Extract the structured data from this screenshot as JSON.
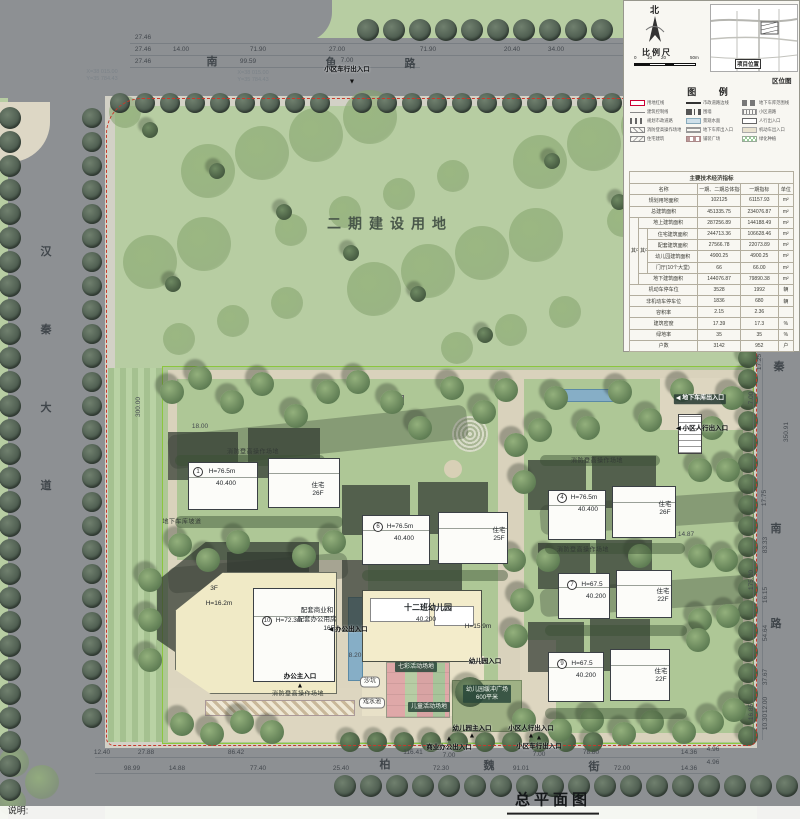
{
  "drawing_title": "总平面图",
  "notes_label": "说明:",
  "compass": {
    "north": "北"
  },
  "scale": {
    "label": "比例尺",
    "ticks": [
      "0",
      "10",
      "20",
      "50m"
    ]
  },
  "location_map": {
    "marker": "项目位置",
    "caption": "区位图"
  },
  "legend": {
    "title": "图  例",
    "items": [
      "用地红线",
      "市政道路边线",
      "地下车库范围线",
      "建筑控制线",
      "围墙",
      "小区道路",
      "规划市政道路",
      "景观水面",
      "人行出入口",
      "消防登高操作场地",
      "地下车库出入口",
      "机动车出入口",
      "住宅建筑",
      "铺装广场",
      "绿化种植"
    ]
  },
  "table": {
    "title": "主要技术经济指标",
    "qizhong": "其中",
    "header": [
      "名称",
      "一期、二期总体指标",
      "一期指标",
      "单位"
    ],
    "rows": [
      [
        "规划用地面积",
        "102125",
        "61157.93",
        "m²"
      ],
      [
        "总建筑面积",
        "451335.75",
        "234076.87",
        "m²"
      ],
      [
        "地上建筑面积",
        "287256.89",
        "144188.49",
        "m²"
      ],
      [
        "住宅建筑面积",
        "244713.36",
        "106628.46",
        "m²"
      ],
      [
        "配套建筑面积",
        "27566.78",
        "22073.89",
        "m²"
      ],
      [
        "幼儿园建筑面积",
        "4900.25",
        "4900.25",
        "m²"
      ],
      [
        "门厅(10个大堂)",
        "66",
        "66.00",
        "m²"
      ],
      [
        "地下建筑面积",
        "144076.87",
        "79890.38",
        "m²"
      ],
      [
        "机动车停车位",
        "3528",
        "1992",
        "辆"
      ],
      [
        "非机动车停车位",
        "1836",
        "680",
        "辆"
      ],
      [
        "容积率",
        "2.15",
        "2.36",
        ""
      ],
      [
        "建筑密度",
        "17.39",
        "17.3",
        "%"
      ],
      [
        "绿地率",
        "35",
        "35",
        "%"
      ],
      [
        "户数",
        "3142",
        "952",
        "户"
      ]
    ]
  },
  "annotations": {
    "headline": [
      {
        "t": "二期建设用地",
        "x": 390,
        "y": 224,
        "c": "big"
      },
      {
        "t": "总平面图",
        "x": 553,
        "y": 803,
        "c": "title"
      },
      {
        "t": "说明:",
        "x": 18,
        "y": 811,
        "c": "note"
      }
    ],
    "roads": [
      {
        "t": "汉",
        "x": 46,
        "y": 253
      },
      {
        "t": "秦",
        "x": 46,
        "y": 331
      },
      {
        "t": "大",
        "x": 46,
        "y": 409
      },
      {
        "t": "道",
        "x": 46,
        "y": 487
      },
      {
        "t": "南",
        "x": 212,
        "y": 63
      },
      {
        "t": "鱼",
        "x": 331,
        "y": 64
      },
      {
        "t": "路",
        "x": 410,
        "y": 65
      },
      {
        "t": "秦",
        "x": 779,
        "y": 368
      },
      {
        "t": "南",
        "x": 776,
        "y": 530
      },
      {
        "t": "路",
        "x": 776,
        "y": 625
      },
      {
        "t": "柏",
        "x": 385,
        "y": 766
      },
      {
        "t": "魏",
        "x": 489,
        "y": 767
      },
      {
        "t": "街",
        "x": 594,
        "y": 768
      }
    ],
    "dims_top": [
      {
        "t": "27.46",
        "x": 143,
        "y": 38
      },
      {
        "t": "27.46",
        "x": 143,
        "y": 50
      },
      {
        "t": "14.00",
        "x": 181,
        "y": 50
      },
      {
        "t": "71.90",
        "x": 258,
        "y": 50
      },
      {
        "t": "27.00",
        "x": 337,
        "y": 50
      },
      {
        "t": "71.90",
        "x": 428,
        "y": 50
      },
      {
        "t": "20.40",
        "x": 512,
        "y": 50
      },
      {
        "t": "34.00",
        "x": 556,
        "y": 50
      },
      {
        "t": "27.46",
        "x": 143,
        "y": 62
      },
      {
        "t": "99.59",
        "x": 248,
        "y": 62
      }
    ],
    "dims_bottom": [
      {
        "t": "12.40",
        "x": 102,
        "y": 753
      },
      {
        "t": "27.88",
        "x": 146,
        "y": 753
      },
      {
        "t": "86.42",
        "x": 236,
        "y": 753
      },
      {
        "t": "116.41",
        "x": 413,
        "y": 753
      },
      {
        "t": "78.80",
        "x": 591,
        "y": 753
      },
      {
        "t": "14.36",
        "x": 689,
        "y": 753
      },
      {
        "t": "4.96",
        "x": 713,
        "y": 750
      },
      {
        "t": "98.99",
        "x": 132,
        "y": 769
      },
      {
        "t": "14.88",
        "x": 177,
        "y": 769
      },
      {
        "t": "77.40",
        "x": 258,
        "y": 769
      },
      {
        "t": "25.40",
        "x": 341,
        "y": 769
      },
      {
        "t": "72.30",
        "x": 441,
        "y": 769
      },
      {
        "t": "91.01",
        "x": 521,
        "y": 769
      },
      {
        "t": "72.00",
        "x": 622,
        "y": 769
      },
      {
        "t": "14.36",
        "x": 689,
        "y": 769
      },
      {
        "t": "4.96",
        "x": 713,
        "y": 763
      }
    ],
    "dims_right": [
      {
        "t": "17.25",
        "x": 760,
        "y": 362,
        "rot": true
      },
      {
        "t": "7.00",
        "x": 752,
        "y": 398,
        "rot": true
      },
      {
        "t": "350.91",
        "x": 787,
        "y": 432,
        "rot": true
      },
      {
        "t": "17.75",
        "x": 765,
        "y": 498,
        "rot": true
      },
      {
        "t": "83.33",
        "x": 766,
        "y": 545,
        "rot": true
      },
      {
        "t": "175.20",
        "x": 752,
        "y": 580,
        "rot": true
      },
      {
        "t": "16.15",
        "x": 766,
        "y": 595,
        "rot": true
      },
      {
        "t": "54.64",
        "x": 766,
        "y": 633,
        "rot": true
      },
      {
        "t": "37.67",
        "x": 766,
        "y": 677,
        "rot": true
      },
      {
        "t": "12.00",
        "x": 766,
        "y": 705,
        "rot": true
      },
      {
        "t": "16.85",
        "x": 752,
        "y": 712,
        "rot": true
      },
      {
        "t": "10.30",
        "x": 766,
        "y": 722,
        "rot": true
      }
    ],
    "dims_other": [
      {
        "t": "300.00",
        "x": 139,
        "y": 407,
        "rot": true
      },
      {
        "t": "18.00",
        "x": 200,
        "y": 427
      },
      {
        "t": "8.20",
        "x": 355,
        "y": 656
      },
      {
        "t": "14.87",
        "x": 686,
        "y": 535
      },
      {
        "t": "7.00",
        "x": 347,
        "y": 61
      },
      {
        "t": "7.00",
        "x": 449,
        "y": 756
      },
      {
        "t": "7.00",
        "x": 539,
        "y": 755
      }
    ],
    "coords": [
      {
        "t": "X=38 015.00\nY=35 784.43",
        "x": 102,
        "y": 76
      },
      {
        "t": "X=38 015.00\nY=35 784.43",
        "x": 253,
        "y": 77
      }
    ],
    "entrances": [
      {
        "t": "小区车行出入口",
        "x": 347,
        "y": 70
      },
      {
        "t": "◀ 地下车库出入口",
        "x": 700,
        "y": 399,
        "c": "entb"
      },
      {
        "t": "◀ 小区人行出入口",
        "x": 702,
        "y": 429
      },
      {
        "t": "◀ 办公出入口",
        "x": 348,
        "y": 630
      },
      {
        "t": "办公主入口",
        "x": 300,
        "y": 677
      },
      {
        "t": "商业办公出入口",
        "x": 449,
        "y": 748
      },
      {
        "t": "幼儿园入口",
        "x": 485,
        "y": 662
      },
      {
        "t": "幼儿园主入口",
        "x": 472,
        "y": 729
      },
      {
        "t": "小区人行出入口",
        "x": 531,
        "y": 729
      },
      {
        "t": "小区车行出入口",
        "x": 539,
        "y": 747
      }
    ],
    "markers": [
      {
        "t": "▼",
        "x": 352,
        "y": 83
      },
      {
        "t": "▲",
        "x": 449,
        "y": 740
      },
      {
        "t": "▲",
        "x": 472,
        "y": 737
      },
      {
        "t": "▲",
        "x": 531,
        "y": 737
      },
      {
        "t": "▲",
        "x": 300,
        "y": 687
      },
      {
        "t": "▲",
        "x": 539,
        "y": 739
      }
    ],
    "fire_fields": [
      {
        "t": "消防登高操作场地",
        "x": 253,
        "y": 453
      },
      {
        "t": "消防登高操作场地",
        "x": 597,
        "y": 462
      },
      {
        "t": "消防登高操作场地",
        "x": 583,
        "y": 551
      },
      {
        "t": "消防登高操作场地",
        "x": 298,
        "y": 695
      }
    ],
    "building_labels": [
      {
        "t": "H=76.5m",
        "x": 222,
        "y": 472
      },
      {
        "t": "40.400",
        "x": 226,
        "y": 484
      },
      {
        "t": "住宅",
        "x": 318,
        "y": 486
      },
      {
        "t": "26F",
        "x": 318,
        "y": 494
      },
      {
        "t": "H=76.5m",
        "x": 400,
        "y": 527
      },
      {
        "t": "40.400",
        "x": 404,
        "y": 539
      },
      {
        "t": "住宅",
        "x": 499,
        "y": 531
      },
      {
        "t": "25F",
        "x": 499,
        "y": 539
      },
      {
        "t": "H=76.5m",
        "x": 584,
        "y": 498
      },
      {
        "t": "40.400",
        "x": 588,
        "y": 510
      },
      {
        "t": "住宅",
        "x": 665,
        "y": 505
      },
      {
        "t": "26F",
        "x": 665,
        "y": 513
      },
      {
        "t": "H=67.5",
        "x": 592,
        "y": 585
      },
      {
        "t": "40.200",
        "x": 596,
        "y": 597
      },
      {
        "t": "住宅",
        "x": 663,
        "y": 592
      },
      {
        "t": "22F",
        "x": 663,
        "y": 600
      },
      {
        "t": "H=67.5",
        "x": 582,
        "y": 664
      },
      {
        "t": "40.200",
        "x": 586,
        "y": 676
      },
      {
        "t": "住宅",
        "x": 661,
        "y": 672
      },
      {
        "t": "22F",
        "x": 661,
        "y": 680
      },
      {
        "t": "3F",
        "x": 214,
        "y": 589
      },
      {
        "t": "H=16.2m",
        "x": 219,
        "y": 604
      },
      {
        "t": "H=72.3m",
        "x": 289,
        "y": 621
      },
      {
        "t": "配套商业和",
        "x": 317,
        "y": 611
      },
      {
        "t": "配套办公用房",
        "x": 317,
        "y": 620
      },
      {
        "t": "16F",
        "x": 329,
        "y": 629
      },
      {
        "t": "十二班幼儿园",
        "x": 428,
        "y": 608,
        "c": "kg"
      },
      {
        "t": "40.200",
        "x": 426,
        "y": 620
      },
      {
        "t": "H=15.9m",
        "x": 478,
        "y": 627
      },
      {
        "t": "地下车库坡道",
        "x": 182,
        "y": 523,
        "c": "tiny"
      }
    ],
    "circles": [
      {
        "t": "1",
        "x": 198,
        "y": 472
      },
      {
        "t": "6",
        "x": 378,
        "y": 527
      },
      {
        "t": "4",
        "x": 562,
        "y": 498
      },
      {
        "t": "7",
        "x": 572,
        "y": 585
      },
      {
        "t": "9",
        "x": 562,
        "y": 664
      },
      {
        "t": "10",
        "x": 267,
        "y": 621
      }
    ],
    "misc_boxes": [
      {
        "t": "沙坑",
        "x": 370,
        "y": 682
      },
      {
        "t": "戏水池",
        "x": 372,
        "y": 703
      }
    ],
    "teal_boxes": [
      {
        "t": "七彩活动场地",
        "x": 416,
        "y": 667
      },
      {
        "t": "儿童活动场地",
        "x": 429,
        "y": 707
      },
      {
        "t": "幼儿园缓冲广场\n600平米",
        "x": 487,
        "y": 694
      }
    ]
  }
}
